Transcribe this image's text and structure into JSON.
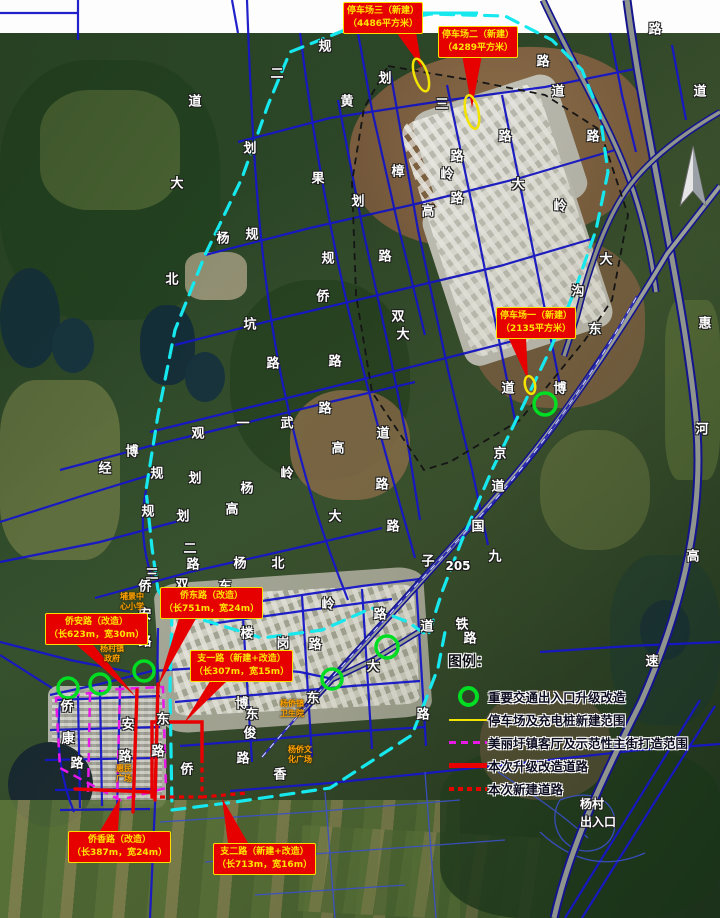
{
  "callouts": {
    "parking3": {
      "l1": "停车场三（新建）",
      "l2": "（4486平方米）"
    },
    "parking2": {
      "l1": "停车场二（新建）",
      "l2": "（4289平方米）"
    },
    "parking1": {
      "l1": "停车场一（新建）",
      "l2": "（2135平方米）"
    },
    "qiaoan": {
      "l1": "侨安路（改造）",
      "l2": "（长623m，宽30m）"
    },
    "qiaodong": {
      "l1": "侨东路（改造）",
      "l2": "（长751m，宽24m）"
    },
    "zhiyi": {
      "l1": "支一路（新建+改造）",
      "l2": "（长307m，宽15m）"
    },
    "qiaoxiang": {
      "l1": "侨香路（改造）",
      "l2": "（长387m，宽24m）"
    },
    "zhier": {
      "l1": "支二路（新建+改造）",
      "l2": "（长713m，宽16m）"
    }
  },
  "legend": {
    "title": "图例：",
    "items": [
      {
        "type": "circle",
        "label": "重要交通出入口升级改造"
      },
      {
        "type": "yellow-line",
        "label": "停车场及充电桩新建范围"
      },
      {
        "type": "magenta-dash",
        "label": "美丽圩镇客厅及示范性主街打造范围"
      },
      {
        "type": "red-solid",
        "label": "本次升级改造道路"
      },
      {
        "type": "red-dash",
        "label": "本次新建道路"
      }
    ]
  },
  "corner_labels": {
    "exit": [
      "杨村",
      "出入口"
    ]
  },
  "road_labels": [
    {
      "x": 195,
      "y": 100,
      "t": "道"
    },
    {
      "x": 177,
      "y": 182,
      "t": "大"
    },
    {
      "x": 172,
      "y": 278,
      "t": "北"
    },
    {
      "x": 277,
      "y": 72,
      "t": "二"
    },
    {
      "x": 325,
      "y": 45,
      "t": "规"
    },
    {
      "x": 385,
      "y": 77,
      "t": "划"
    },
    {
      "x": 347,
      "y": 100,
      "t": "黄"
    },
    {
      "x": 250,
      "y": 147,
      "t": "划"
    },
    {
      "x": 318,
      "y": 177,
      "t": "果"
    },
    {
      "x": 358,
      "y": 200,
      "t": "划"
    },
    {
      "x": 252,
      "y": 233,
      "t": "规"
    },
    {
      "x": 223,
      "y": 237,
      "t": "杨"
    },
    {
      "x": 328,
      "y": 257,
      "t": "规"
    },
    {
      "x": 385,
      "y": 255,
      "t": "路"
    },
    {
      "x": 442,
      "y": 103,
      "t": "三"
    },
    {
      "x": 505,
      "y": 135,
      "t": "路"
    },
    {
      "x": 457,
      "y": 155,
      "t": "路"
    },
    {
      "x": 447,
      "y": 173,
      "t": "岭"
    },
    {
      "x": 398,
      "y": 170,
      "t": "樟"
    },
    {
      "x": 457,
      "y": 197,
      "t": "路"
    },
    {
      "x": 428,
      "y": 210,
      "t": "高"
    },
    {
      "x": 518,
      "y": 183,
      "t": "大"
    },
    {
      "x": 560,
      "y": 205,
      "t": "岭"
    },
    {
      "x": 558,
      "y": 90,
      "t": "道"
    },
    {
      "x": 593,
      "y": 135,
      "t": "路"
    },
    {
      "x": 543,
      "y": 60,
      "t": "路"
    },
    {
      "x": 655,
      "y": 28,
      "t": "路"
    },
    {
      "x": 700,
      "y": 90,
      "t": "道"
    },
    {
      "x": 606,
      "y": 258,
      "t": "大"
    },
    {
      "x": 578,
      "y": 290,
      "t": "沟"
    },
    {
      "x": 595,
      "y": 328,
      "t": "东"
    },
    {
      "x": 560,
      "y": 387,
      "t": "博"
    },
    {
      "x": 508,
      "y": 387,
      "t": "道"
    },
    {
      "x": 500,
      "y": 452,
      "t": "京"
    },
    {
      "x": 498,
      "y": 485,
      "t": "道"
    },
    {
      "x": 478,
      "y": 525,
      "t": "国"
    },
    {
      "x": 495,
      "y": 555,
      "t": "九"
    },
    {
      "x": 458,
      "y": 566,
      "t": "205"
    },
    {
      "x": 462,
      "y": 623,
      "t": "铁"
    },
    {
      "x": 470,
      "y": 637,
      "t": "路"
    },
    {
      "x": 323,
      "y": 295,
      "t": "侨"
    },
    {
      "x": 250,
      "y": 323,
      "t": "坑"
    },
    {
      "x": 398,
      "y": 315,
      "t": "双"
    },
    {
      "x": 403,
      "y": 333,
      "t": "大"
    },
    {
      "x": 273,
      "y": 362,
      "t": "路"
    },
    {
      "x": 335,
      "y": 360,
      "t": "路"
    },
    {
      "x": 325,
      "y": 407,
      "t": "路"
    },
    {
      "x": 287,
      "y": 422,
      "t": "武"
    },
    {
      "x": 243,
      "y": 422,
      "t": "一"
    },
    {
      "x": 198,
      "y": 432,
      "t": "观"
    },
    {
      "x": 338,
      "y": 447,
      "t": "高"
    },
    {
      "x": 287,
      "y": 472,
      "t": "岭"
    },
    {
      "x": 383,
      "y": 432,
      "t": "道"
    },
    {
      "x": 382,
      "y": 483,
      "t": "路"
    },
    {
      "x": 335,
      "y": 515,
      "t": "大"
    },
    {
      "x": 393,
      "y": 525,
      "t": "路"
    },
    {
      "x": 132,
      "y": 450,
      "t": "博"
    },
    {
      "x": 105,
      "y": 467,
      "t": "经"
    },
    {
      "x": 157,
      "y": 472,
      "t": "规"
    },
    {
      "x": 195,
      "y": 477,
      "t": "划"
    },
    {
      "x": 247,
      "y": 487,
      "t": "杨"
    },
    {
      "x": 148,
      "y": 510,
      "t": "规"
    },
    {
      "x": 183,
      "y": 515,
      "t": "划"
    },
    {
      "x": 232,
      "y": 508,
      "t": "高"
    },
    {
      "x": 190,
      "y": 547,
      "t": "二"
    },
    {
      "x": 193,
      "y": 563,
      "t": "路"
    },
    {
      "x": 240,
      "y": 562,
      "t": "杨"
    },
    {
      "x": 278,
      "y": 562,
      "t": "北"
    },
    {
      "x": 152,
      "y": 573,
      "t": "三"
    },
    {
      "x": 145,
      "y": 585,
      "t": "侨"
    },
    {
      "x": 182,
      "y": 583,
      "t": "双"
    },
    {
      "x": 225,
      "y": 585,
      "t": "东"
    },
    {
      "x": 428,
      "y": 560,
      "t": "子"
    },
    {
      "x": 328,
      "y": 603,
      "t": "岭"
    },
    {
      "x": 380,
      "y": 613,
      "t": "路"
    },
    {
      "x": 427,
      "y": 625,
      "t": "道"
    },
    {
      "x": 373,
      "y": 665,
      "t": "大"
    },
    {
      "x": 313,
      "y": 697,
      "t": "东"
    },
    {
      "x": 315,
      "y": 643,
      "t": "路"
    },
    {
      "x": 423,
      "y": 713,
      "t": "路"
    },
    {
      "x": 280,
      "y": 773,
      "t": "香"
    },
    {
      "x": 67,
      "y": 705,
      "t": "侨"
    },
    {
      "x": 68,
      "y": 737,
      "t": "康"
    },
    {
      "x": 77,
      "y": 762,
      "t": "路"
    },
    {
      "x": 128,
      "y": 723,
      "t": "安"
    },
    {
      "x": 125,
      "y": 755,
      "t": "路"
    },
    {
      "x": 163,
      "y": 718,
      "t": "东"
    },
    {
      "x": 158,
      "y": 750,
      "t": "路"
    },
    {
      "x": 187,
      "y": 768,
      "t": "侨"
    },
    {
      "x": 242,
      "y": 702,
      "t": "博"
    },
    {
      "x": 252,
      "y": 713,
      "t": "东"
    },
    {
      "x": 250,
      "y": 732,
      "t": "俊"
    },
    {
      "x": 243,
      "y": 757,
      "t": "路"
    },
    {
      "x": 145,
      "y": 613,
      "t": "安"
    },
    {
      "x": 145,
      "y": 640,
      "t": "路"
    },
    {
      "x": 247,
      "y": 632,
      "t": "楼"
    },
    {
      "x": 283,
      "y": 642,
      "t": "岗"
    },
    {
      "x": 705,
      "y": 322,
      "t": "惠"
    },
    {
      "x": 702,
      "y": 428,
      "t": "河"
    },
    {
      "x": 693,
      "y": 555,
      "t": "高"
    },
    {
      "x": 652,
      "y": 660,
      "t": "速"
    }
  ],
  "poi_labels": [
    {
      "x": 132,
      "y": 602,
      "lines": [
        "埔景中",
        "心小学"
      ]
    },
    {
      "x": 112,
      "y": 654,
      "lines": [
        "杨村镇",
        "政府"
      ]
    },
    {
      "x": 292,
      "y": 709,
      "lines": [
        "杨侨镇",
        "卫生院"
      ]
    },
    {
      "x": 300,
      "y": 755,
      "lines": [
        "杨侨文",
        "化广场"
      ]
    },
    {
      "x": 124,
      "y": 774,
      "lines": [
        "惠民",
        "广场"
      ]
    }
  ],
  "colors": {
    "road_blue": "#1616c8",
    "boundary_cyan": "#16e8ee",
    "street_magenta": "#e818e8",
    "upgrade_red": "#e80000",
    "parking_yellow": "#f2e300",
    "entrance_green": "#00dd22"
  }
}
